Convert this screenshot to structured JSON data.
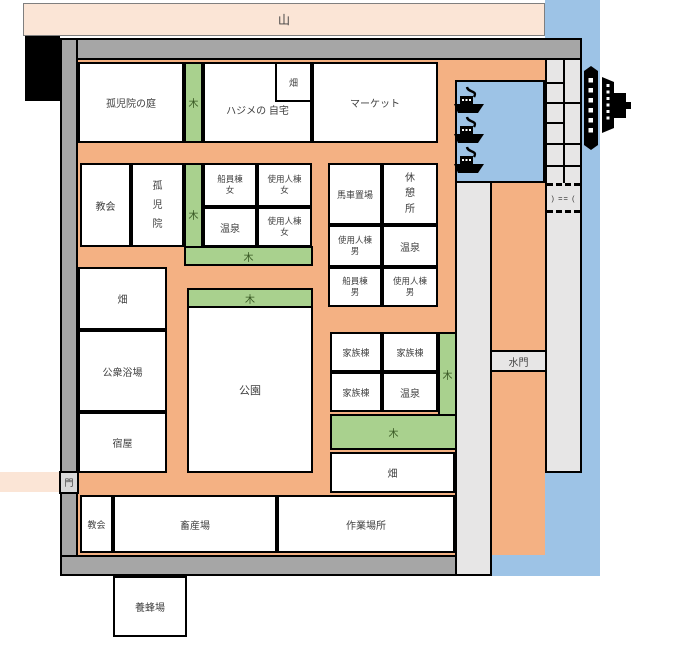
{
  "map_title": {
    "mountain": "山"
  },
  "labels": {
    "orphanage_garden": "孤児院の庭",
    "tree": "木",
    "hajime_home": "ハジメの 自宅",
    "field": "畑",
    "market": "マーケット",
    "church": "教会",
    "orphanage": "孤\n児\n院",
    "sailor_women": "船員棟\n女",
    "servant_women": "使用人棟\n女",
    "hot_spring": "温泉",
    "carriage_depot": "馬車置場",
    "rest_area": "休\n憩\n所",
    "servant_men": "使用人棟\n男",
    "sailor_men": "船員棟\n男",
    "family_quarters": "家族棟",
    "public_bath": "公衆浴場",
    "inn": "宿屋",
    "park": "公園",
    "gate": "門",
    "water_gate": "水門",
    "livestock_farm": "畜産場",
    "work_site": "作業場所",
    "apiary": "養蜂場"
  },
  "harbor": {
    "lock_marker": ") == (",
    "boat_count": 3
  },
  "colors": {
    "water": "#9dc3e6",
    "path": "#f4b183",
    "tree_green": "#a9d18e",
    "wall_gray": "#a6a6a6",
    "dock_gray": "#e7e6e6",
    "mountain_pink": "#fbe5d6",
    "building_white": "#ffffff",
    "outline_black": "#000000"
  }
}
